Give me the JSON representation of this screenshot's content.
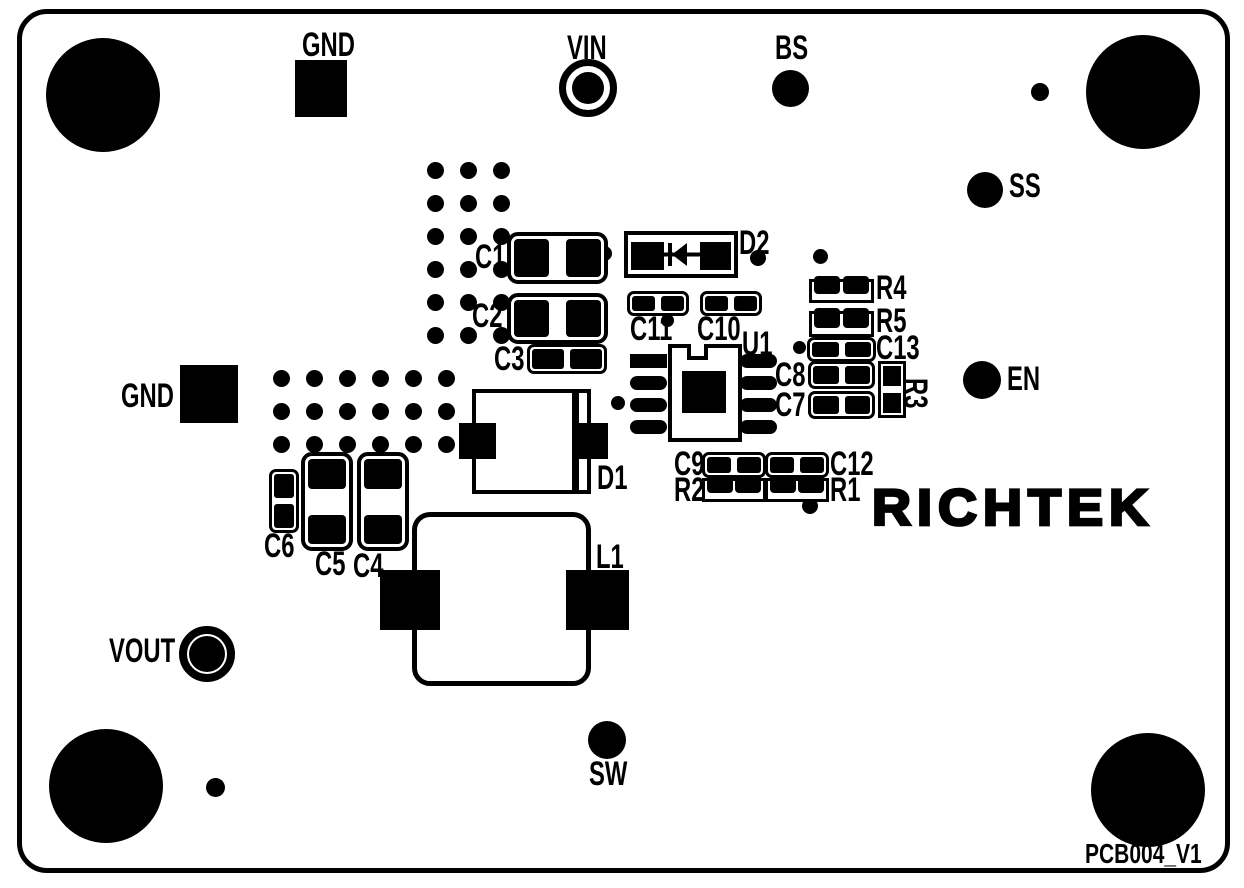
{
  "board": {
    "brand": "RICHTEK",
    "version": "PCB004_V1",
    "colors": {
      "silkscreen": "#000000",
      "board": "#ffffff"
    }
  },
  "connectors": {
    "gnd_top": "GND",
    "vin": "VIN",
    "bs": "BS",
    "ss": "SS",
    "en": "EN",
    "gnd_left": "GND",
    "vout": "VOUT",
    "sw": "SW"
  },
  "components": {
    "c1": "C1",
    "c2": "C2",
    "c3": "C3",
    "c4": "C4",
    "c5": "C5",
    "c6": "C6",
    "c7": "C7",
    "c8": "C8",
    "c9": "C9",
    "c10": "C10",
    "c11": "C11",
    "c12": "C12",
    "c13": "C13",
    "r1": "R1",
    "r2": "R2",
    "r3": "R3",
    "r4": "R4",
    "r5": "R5",
    "d1": "D1",
    "d2": "D2",
    "l1": "L1",
    "u1": "U1"
  },
  "via_grids": {
    "top": {
      "cols": 3,
      "rows": 6,
      "spacing": 33,
      "dot_size": 17
    },
    "left": {
      "cols": 6,
      "rows": 3,
      "spacing": 33,
      "dot_size": 17
    }
  }
}
